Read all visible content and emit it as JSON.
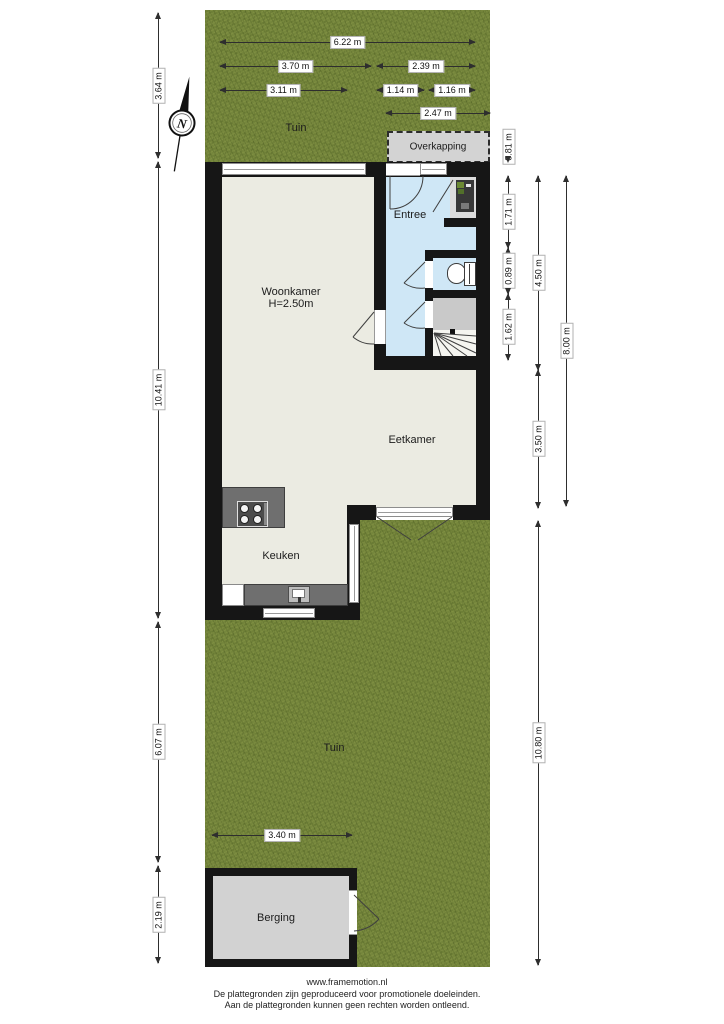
{
  "rooms": {
    "tuin_top": "Tuin",
    "overkapping": "Overkapping",
    "entree": "Entree",
    "woonkamer": "Woonkamer",
    "woonkamer_height": "H=2.50m",
    "eetkamer": "Eetkamer",
    "keuken": "Keuken",
    "tuin_bottom": "Tuin",
    "berging": "Berging"
  },
  "compass": {
    "letter": "N"
  },
  "dimensions": {
    "top": {
      "d622": "6.22 m",
      "d370": "3.70 m",
      "d239": "2.39 m",
      "d311": "3.11 m",
      "d114": "1.14 m",
      "d116": "1.16 m",
      "d247": "2.47 m"
    },
    "left": {
      "d364": "3.64 m",
      "d1041": "10.41 m",
      "d607": "6.07 m",
      "d219": "2.19 m"
    },
    "right": {
      "d081": "0.81 m",
      "d171": "1.71 m",
      "d089": "0.89 m",
      "d162": "1.62 m",
      "d450": "4.50 m",
      "d350": "3.50 m",
      "d800": "8.00 m",
      "d1080": "10.80 m"
    },
    "bottom": {
      "d340": "3.40 m"
    }
  },
  "footer": {
    "line1": "www.framemotion.nl",
    "line2": "De plattegronden zijn geproduceerd voor promotionele doeleinden.",
    "line3": "Aan de plattegronden kunnen geen rechten worden ontleend."
  },
  "colors": {
    "grass": "#75863c",
    "floor": "#ebebe2",
    "hall": "#cfe7f6",
    "wall": "#161616",
    "overkapping": "#d3d3d3"
  }
}
